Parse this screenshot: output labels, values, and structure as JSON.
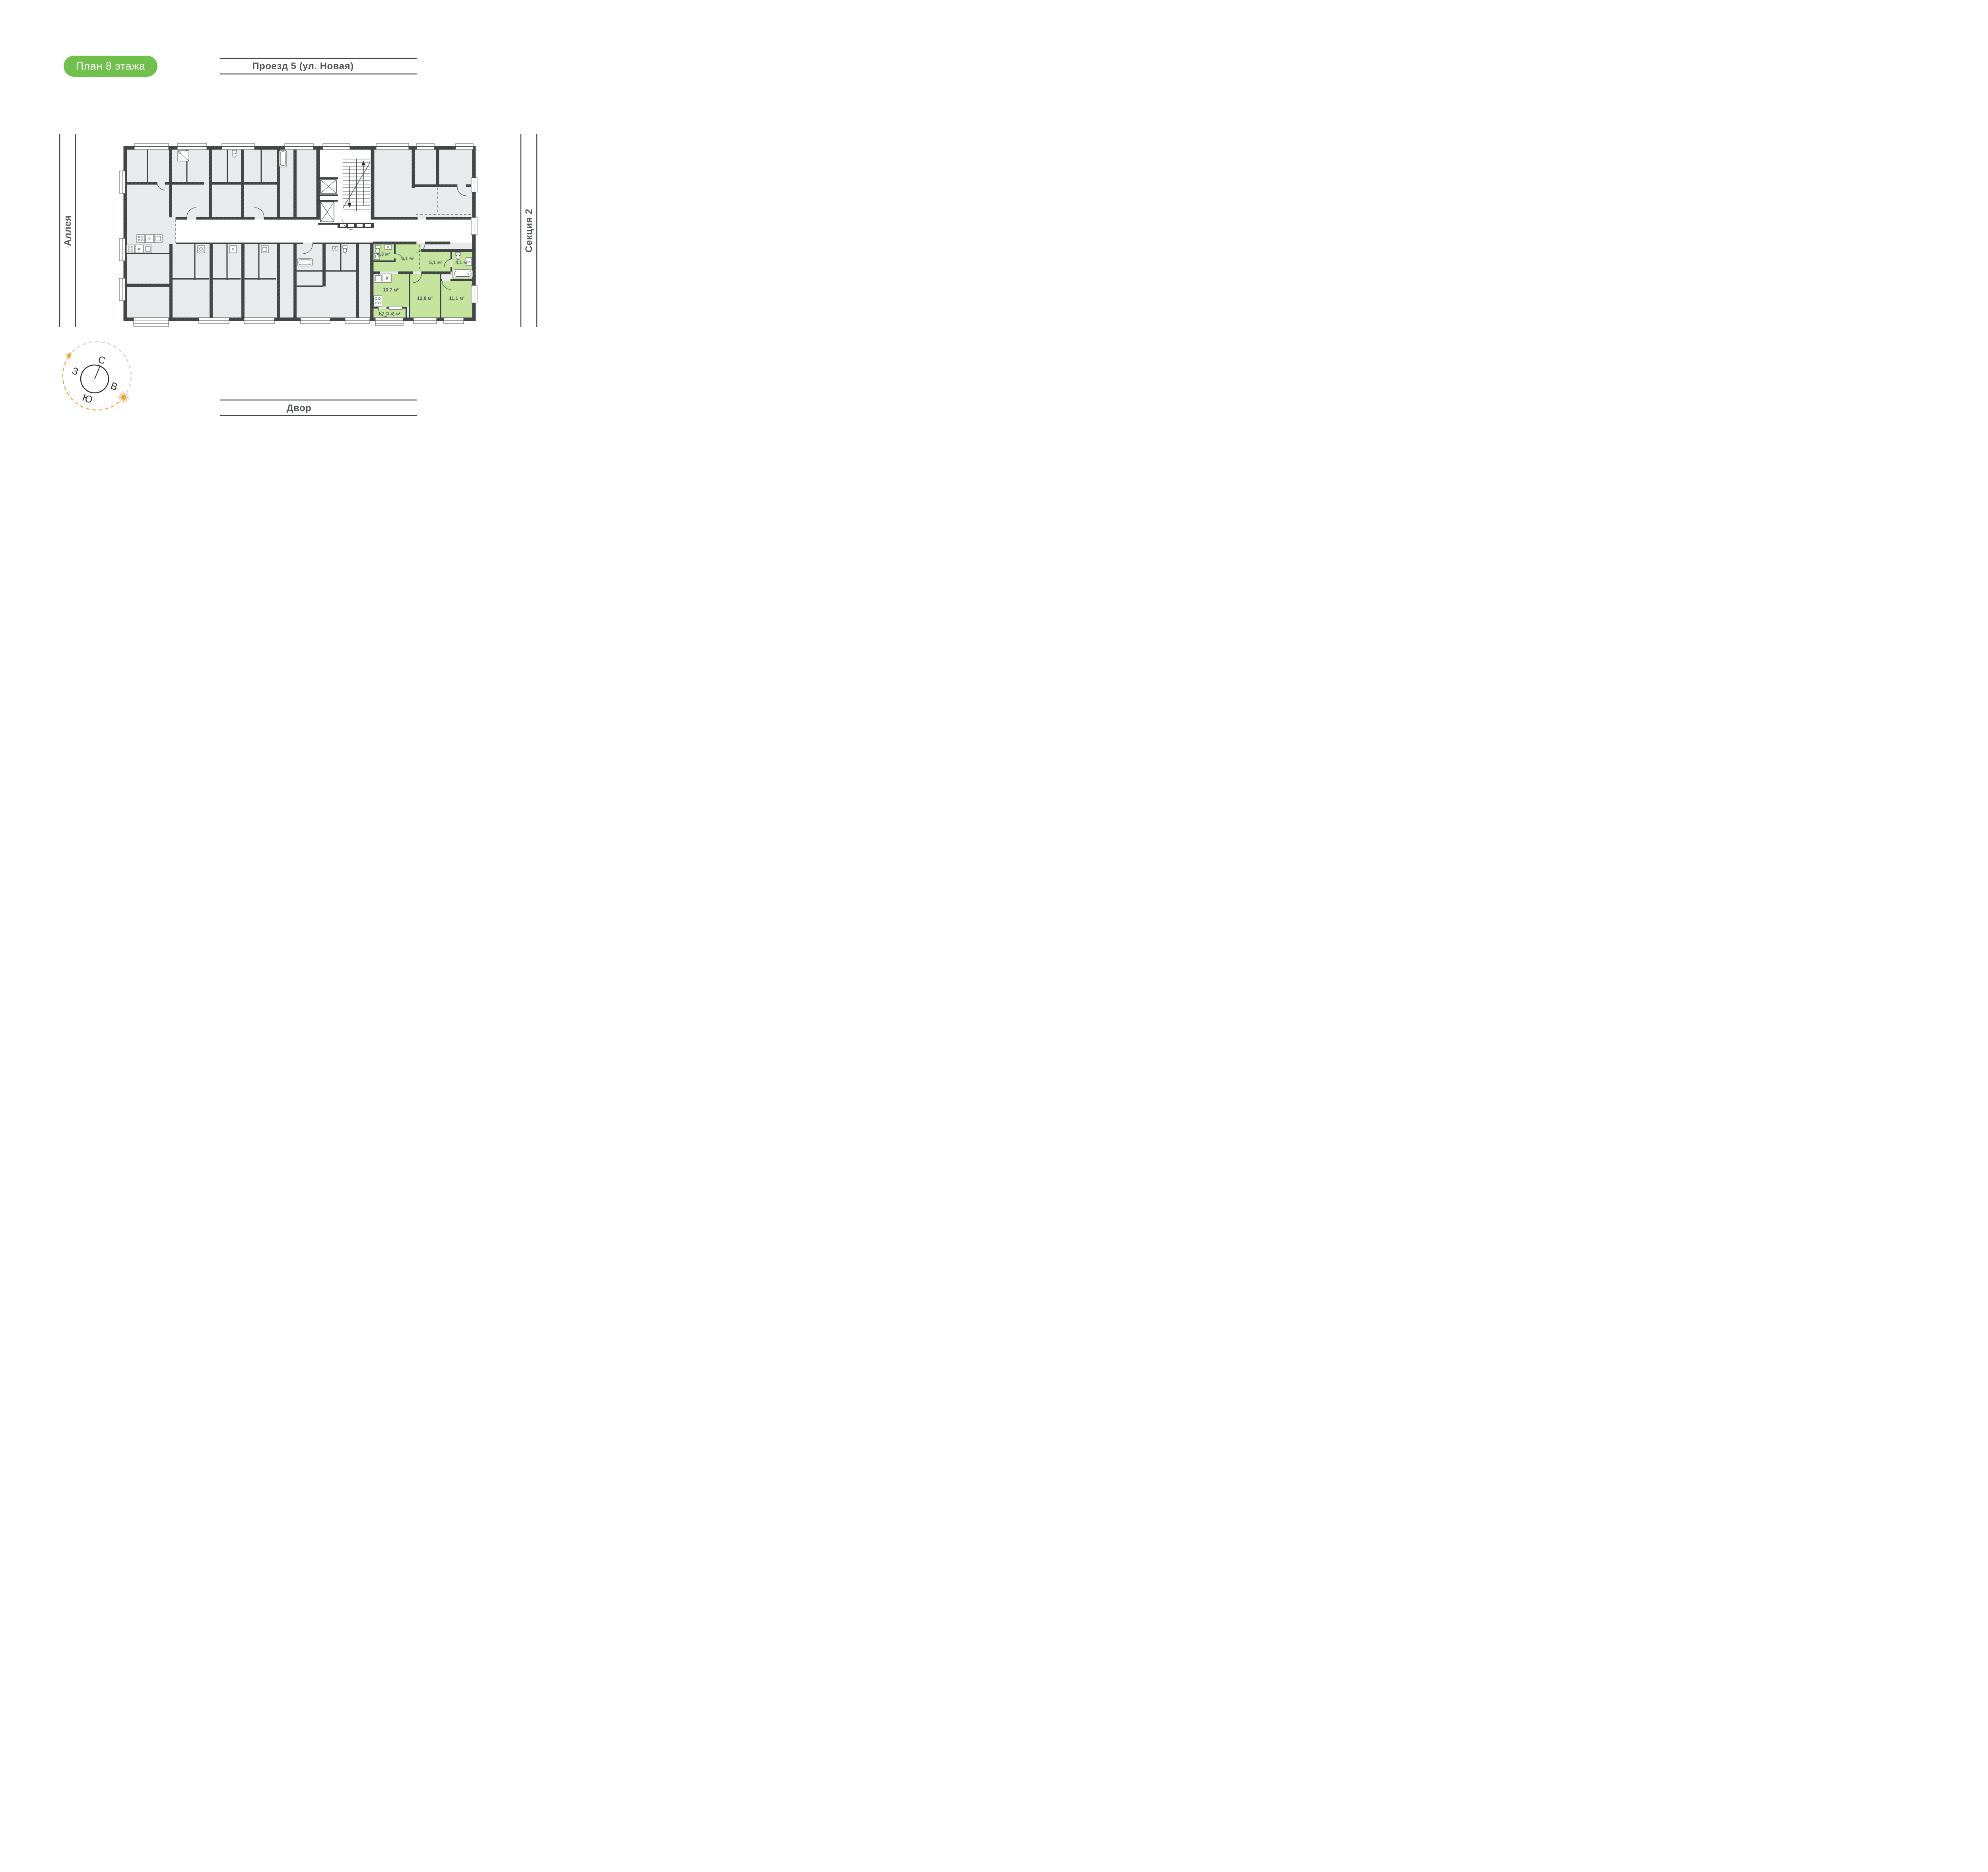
{
  "badge": {
    "label": "План 8 этажа"
  },
  "surroundings": {
    "street_top": "Проезд 5 (ул. Новая)",
    "alley_left": "Аллея",
    "section_right": "Секция 2",
    "yard_bottom": "Двор"
  },
  "floor_plan": {
    "highlighted_apartment": {
      "rooms": [
        {
          "name": "bathroom-small",
          "area": "4,3 м²"
        },
        {
          "name": "hallway",
          "area": "6,1 м²"
        },
        {
          "name": "inner-corridor",
          "area": "5,1 м²"
        },
        {
          "name": "bathroom",
          "area": "4,1 м²"
        },
        {
          "name": "kitchen",
          "area": "10,7 м²"
        },
        {
          "name": "bedroom-1",
          "area": "12,8 м²"
        },
        {
          "name": "bedroom-2",
          "area": "11,1 м²"
        },
        {
          "name": "balcony",
          "area": "1,7 (3,4) м²"
        }
      ]
    }
  },
  "compass": {
    "north": "С",
    "east": "В",
    "south": "Ю",
    "west": "З"
  },
  "colors": {
    "badge_green": "#6fc14b",
    "highlight_fill": "#c5e49e",
    "wall_dark": "#3e4245",
    "room_fill": "#e9eaeb",
    "accent_orange": "#f5a623",
    "label_gray": "#55585b"
  }
}
